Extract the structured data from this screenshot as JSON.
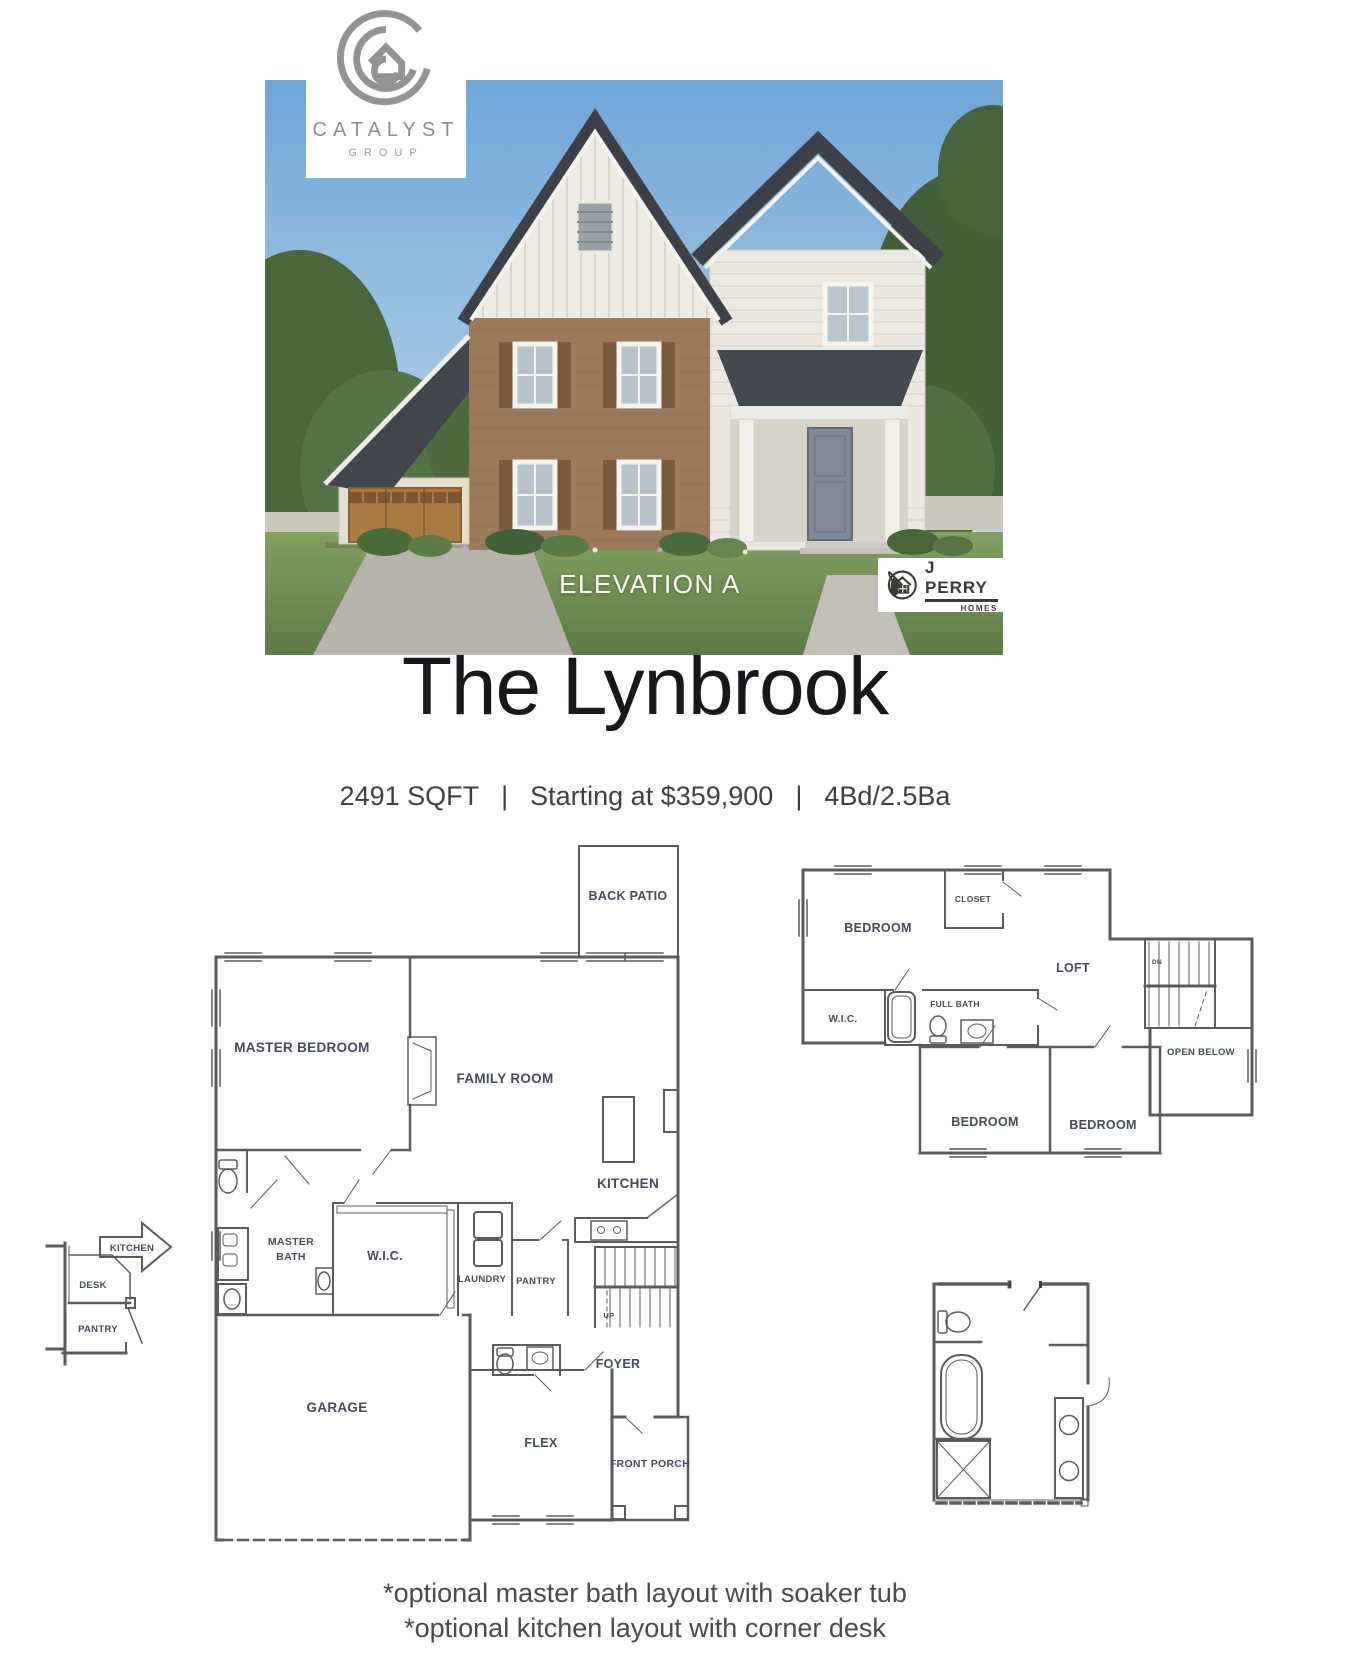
{
  "branding": {
    "catalyst_name": "CATALYST",
    "catalyst_group": "GROUP",
    "builder_name": "J PERRY",
    "builder_homes": "HOMES",
    "elevation_label": "ELEVATION A",
    "catalyst_logo_color": "#8d8d8d",
    "builder_logo_color": "#3a3a36"
  },
  "header": {
    "title": "The Lynbrook",
    "sqft": "2491 SQFT",
    "price": "Starting at $359,900",
    "beds_baths": "4Bd/2.5Ba",
    "separator": "|"
  },
  "first_floor": {
    "back_patio": "BACK PATIO",
    "master_bedroom": "MASTER BEDROOM",
    "family_room": "FAMILY ROOM",
    "kitchen": "KITCHEN",
    "master_bath_line1": "MASTER",
    "master_bath_line2": "BATH",
    "wic": "W.I.C.",
    "laundry": "LAUNDRY",
    "pantry": "PANTRY",
    "up": "UP",
    "foyer": "FOYER",
    "garage": "GARAGE",
    "flex": "FLEX",
    "front_porch": "FRONT PORCH"
  },
  "second_floor": {
    "bedroom_left": "BEDROOM",
    "closet": "CLOSET",
    "loft": "LOFT",
    "wic": "W.I.C.",
    "full_bath": "FULL BATH",
    "dn": "DN",
    "open_below": "OPEN BELOW",
    "bedroom_middle": "BEDROOM",
    "bedroom_right": "BEDROOM"
  },
  "optional_kitchen": {
    "arrow_label": "KITCHEN",
    "desk": "DESK",
    "pantry": "PANTRY"
  },
  "footer": {
    "note_line1": "*optional master bath layout with soaker tub",
    "note_line2": "*optional kitchen layout with corner desk"
  },
  "plan_colors": {
    "wall": "#595b5e",
    "label": "#454b57",
    "accent_red": "#d84b40"
  }
}
